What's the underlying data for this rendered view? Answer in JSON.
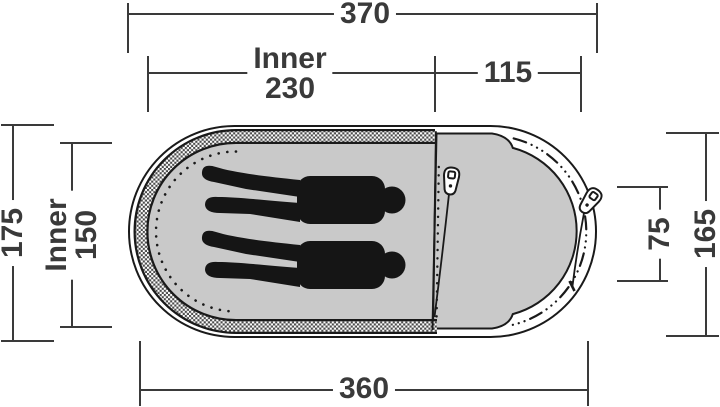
{
  "diagram": {
    "dimensions": {
      "top_total": "370",
      "top_inner_label": "Inner",
      "top_inner_value": "230",
      "top_porch": "115",
      "left_total": "175",
      "left_inner_label": "Inner",
      "left_inner_value": "150",
      "right_door": "75",
      "right_total": "165",
      "bottom_total": "360"
    },
    "colors": {
      "floor_gray": "#c9c9c9",
      "outline": "#1a1a1a",
      "dimension": "#3a3a3a",
      "silhouette": "#151515"
    },
    "icons": {
      "zipper_pull": "zipper-pull-icon",
      "person": "person-silhouette",
      "mesh": "mesh-band"
    }
  }
}
